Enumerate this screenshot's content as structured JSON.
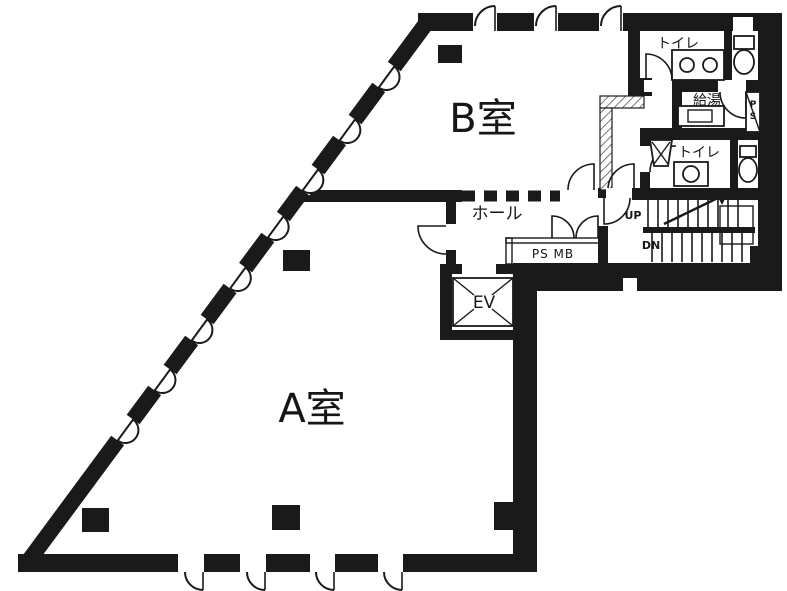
{
  "rooms": {
    "room_b": {
      "label": "B室"
    },
    "room_a": {
      "label": "A室"
    },
    "hall": {
      "label": "ホール"
    },
    "toilet_top": {
      "label": "トイレ"
    },
    "toilet_bottom": {
      "label": "トイレ"
    },
    "kitchenette": {
      "label": "給湯"
    },
    "ps_mb": {
      "label": "PS MB"
    },
    "elevator": {
      "label": "EV"
    },
    "pipe_shaft": {
      "p": "P",
      "s": "S"
    },
    "stairs": {
      "up": "UP",
      "down": "DN"
    }
  },
  "colors": {
    "wall": "#1a1a1a",
    "floor": "#ffffff",
    "line": "#1a1a1a"
  }
}
